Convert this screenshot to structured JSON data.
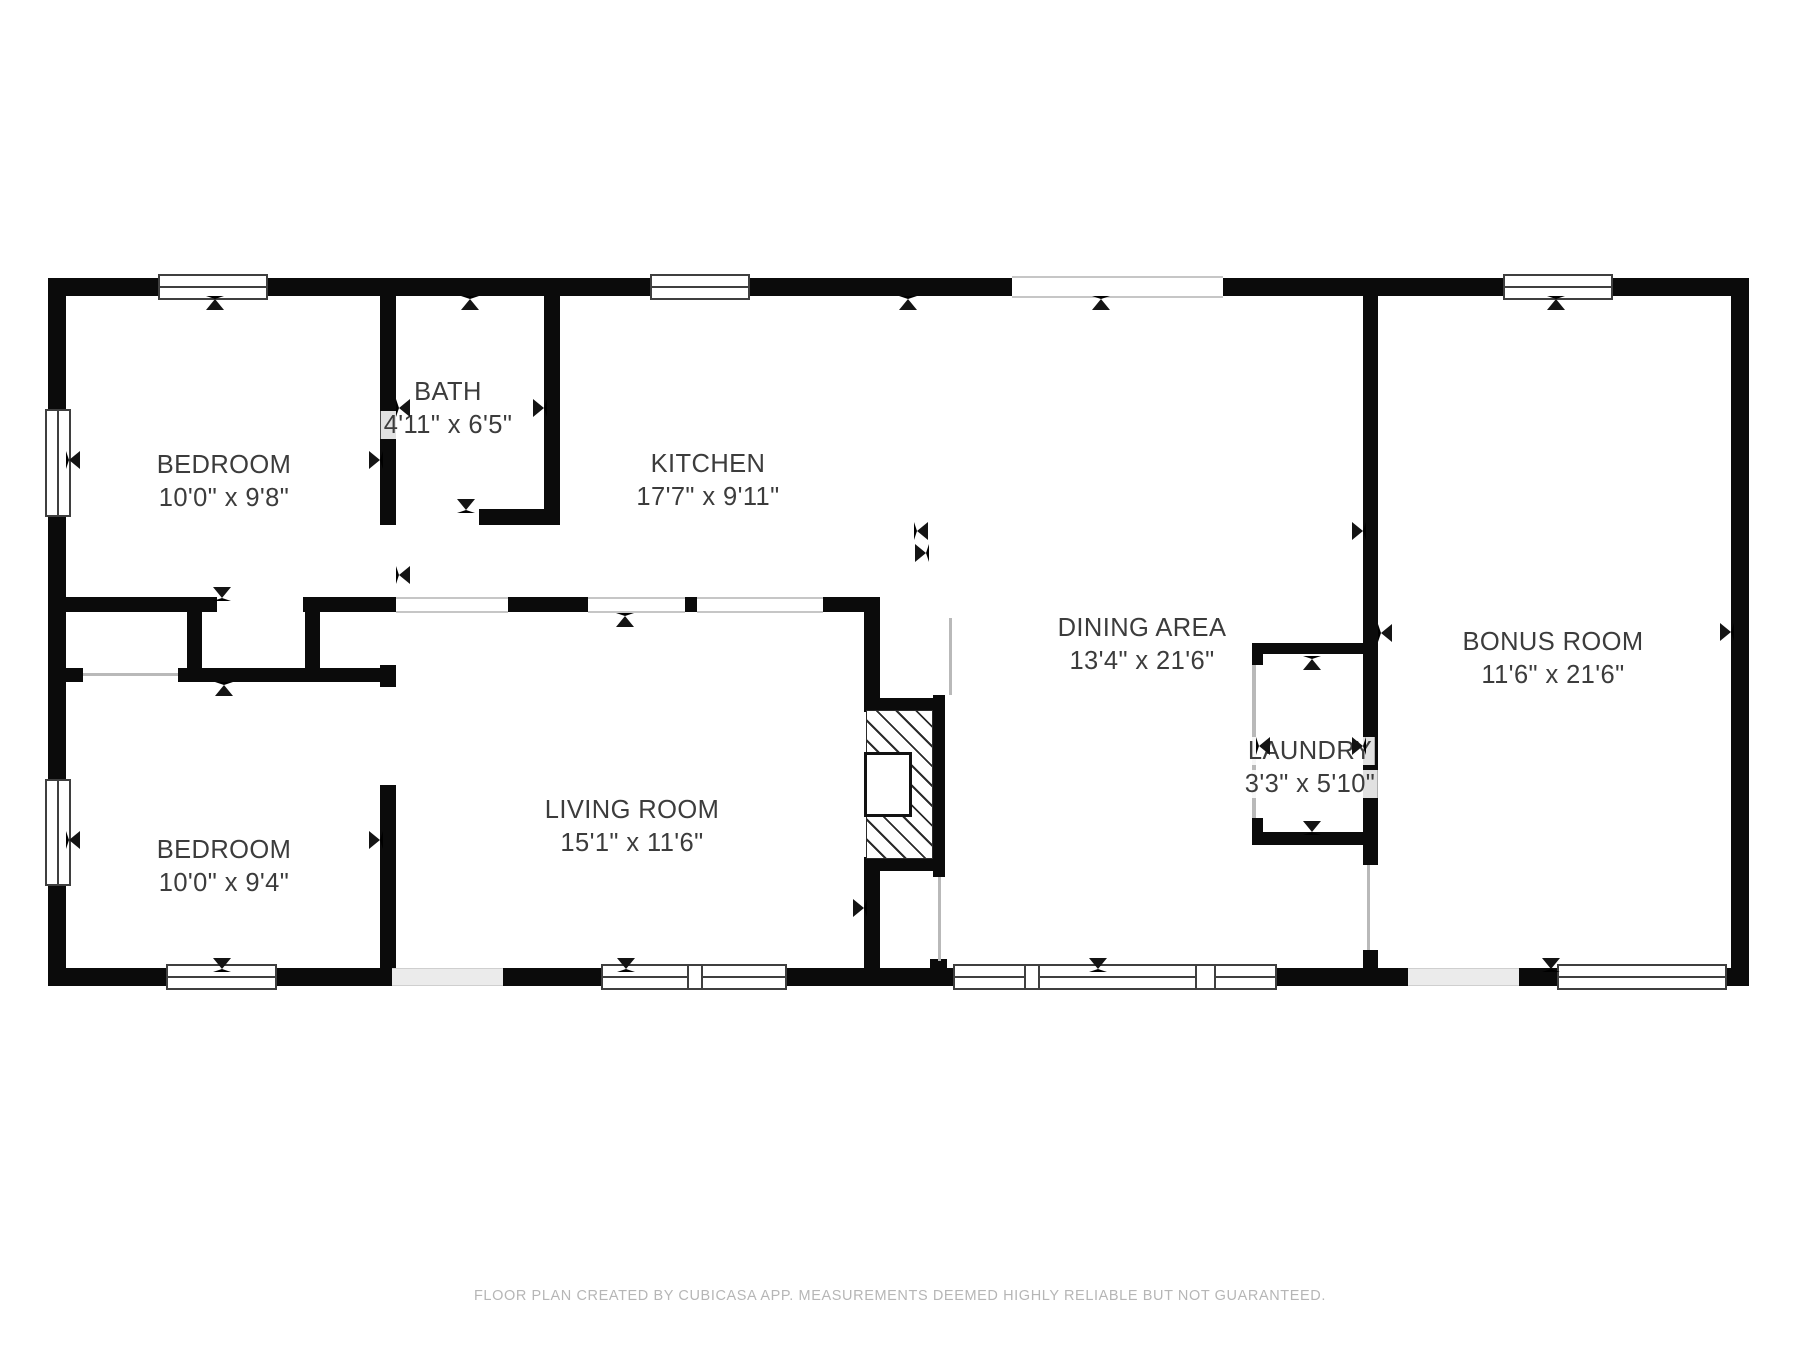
{
  "title": "Floor plan",
  "colors": {
    "wall": "#0b0b0b",
    "window_frame": "#3f3f3f",
    "label_text": "#3c3c3c",
    "footer_text": "#b6b6b6",
    "background": "#ffffff"
  },
  "rooms": [
    {
      "id": "bedroom-1",
      "name": "BEDROOM",
      "dims": "10'0\" x 9'8\""
    },
    {
      "id": "bath",
      "name": "BATH",
      "dims": "4'11\" x 6'5\""
    },
    {
      "id": "kitchen",
      "name": "KITCHEN",
      "dims": "17'7\" x 9'11\""
    },
    {
      "id": "dining-area",
      "name": "DINING AREA",
      "dims": "13'4\" x 21'6\""
    },
    {
      "id": "bonus-room",
      "name": "BONUS ROOM",
      "dims": "11'6\" x 21'6\""
    },
    {
      "id": "living-room",
      "name": "LIVING ROOM",
      "dims": "15'1\" x 11'6\""
    },
    {
      "id": "bedroom-2",
      "name": "BEDROOM",
      "dims": "10'0\" x 9'4\""
    },
    {
      "id": "laundry",
      "name": "LAUNDRY",
      "dims": "3'3\" x 5'10\""
    }
  ],
  "footer": "FLOOR PLAN CREATED BY CUBICASA APP. MEASUREMENTS DEEMED HIGHLY RELIABLE BUT NOT GUARANTEED."
}
